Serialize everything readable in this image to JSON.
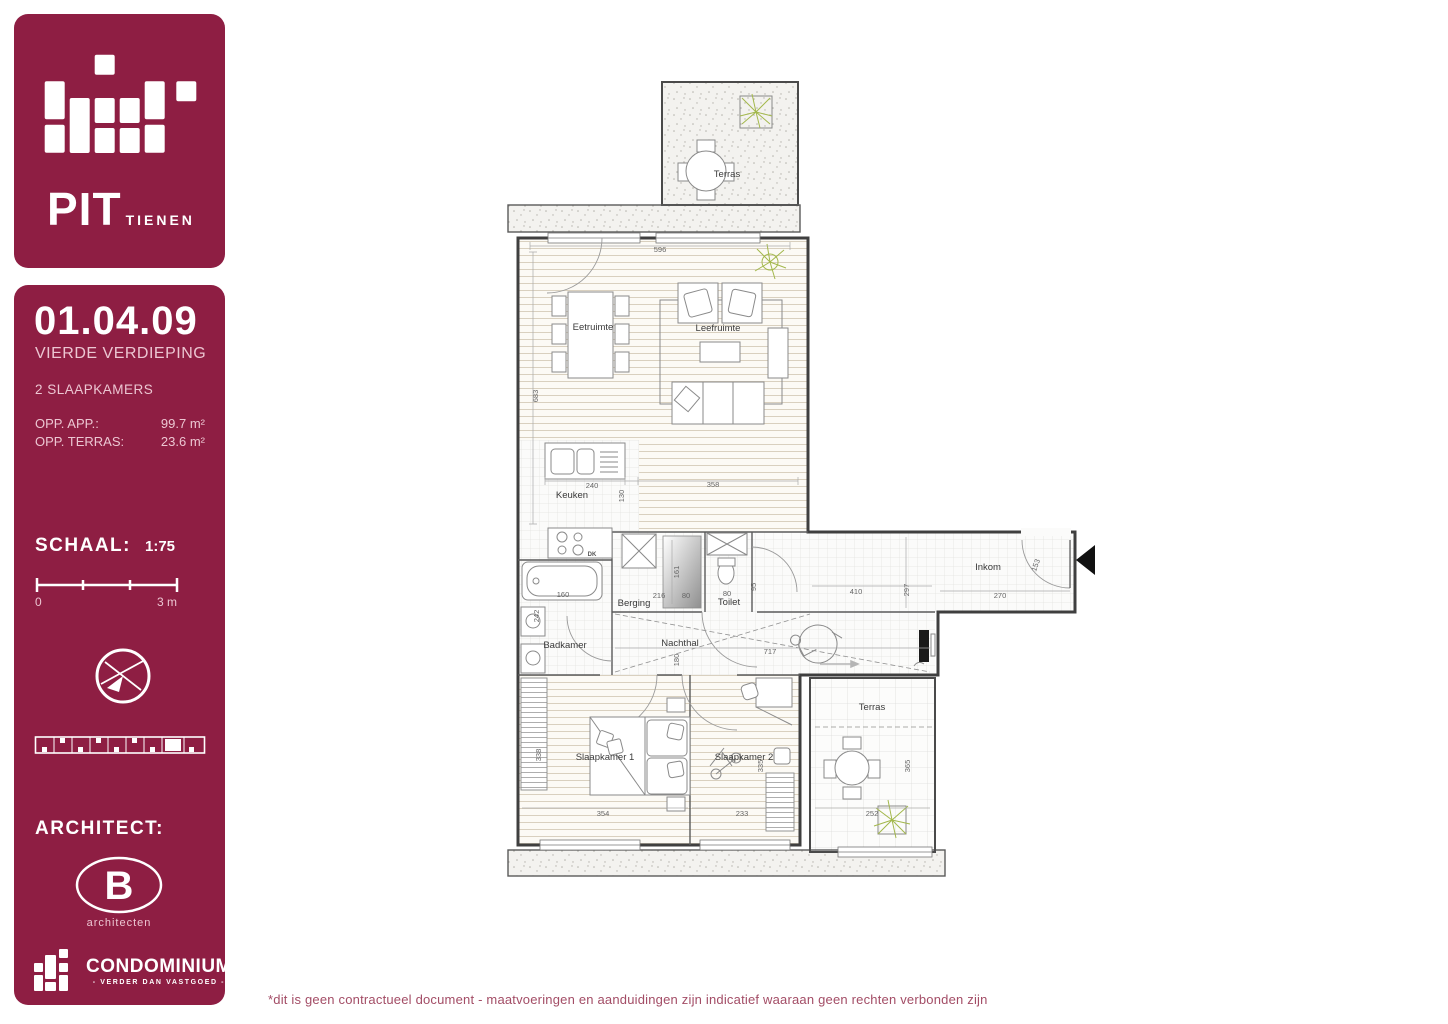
{
  "sidebar": {
    "brand": {
      "name": "PIT",
      "city": "TIENEN"
    },
    "unit": {
      "code": "01.04.09",
      "floor": "VIERDE VERDIEPING",
      "bedrooms": "2 SLAAPKAMERS",
      "area_app_label": "OPP. APP.:",
      "area_app_value": "99.7  m²",
      "area_terras_label": "OPP. TERRAS:",
      "area_terras_value": "23.6  m²"
    },
    "scale": {
      "label": "SCHAAL:",
      "value": "1:75",
      "bar_start": "0",
      "bar_end": "3 m"
    },
    "architect": {
      "label": "ARCHITECT:",
      "logo_letter": "B",
      "logo_name": "architecten"
    },
    "developer": {
      "name": "CONDOMINIUM",
      "tagline": "- VERDER DAN VASTGOED -"
    }
  },
  "plan": {
    "rooms": {
      "terras_top": "Terras",
      "eetruimte": "Eetruimte",
      "leefruimte": "Leefruimte",
      "keuken": "Keuken",
      "berging": "Berging",
      "toilet": "Toilet",
      "inkom": "Inkom",
      "badkamer": "Badkamer",
      "nachthal": "Nachthal",
      "slaapkamer1": "Slaapkamer 1",
      "slaapkamer2": "Slaapkamer 2",
      "terras_bottom": "Terras"
    },
    "dims": {
      "top_width": "596",
      "living_h": "683",
      "keuken_w": "240",
      "keuken_h": "130",
      "living_w": "358",
      "bad_tub": "160",
      "bad_h": "242",
      "berging_w": "216",
      "shaft_w": "80",
      "toilet_w": "80",
      "shaft_h": "161",
      "toilet_door": "95",
      "hal_w": "410",
      "hal_h": "297",
      "inkom_w": "270",
      "inkom_door": "153",
      "nachthal_w": "717",
      "nachthal_h": "180",
      "sk1_w": "354",
      "sk2_w": "233",
      "sk1_h": "338",
      "sk2_h": "335",
      "terras_w": "252",
      "terras_h": "365"
    },
    "appliances": {
      "hob": "DK"
    }
  },
  "footer": {
    "disclaimer": "*dit is geen contractueel document - maatvoeringen en aanduidingen zijn indicatief waaraan geen rechten verbonden zijn"
  },
  "colors": {
    "brand": "#8e1e43",
    "soft_text": "#ecc6d2",
    "disclaimer": "#a34d66",
    "plant": "#a3b84c",
    "wall": "#3f3f3f"
  }
}
